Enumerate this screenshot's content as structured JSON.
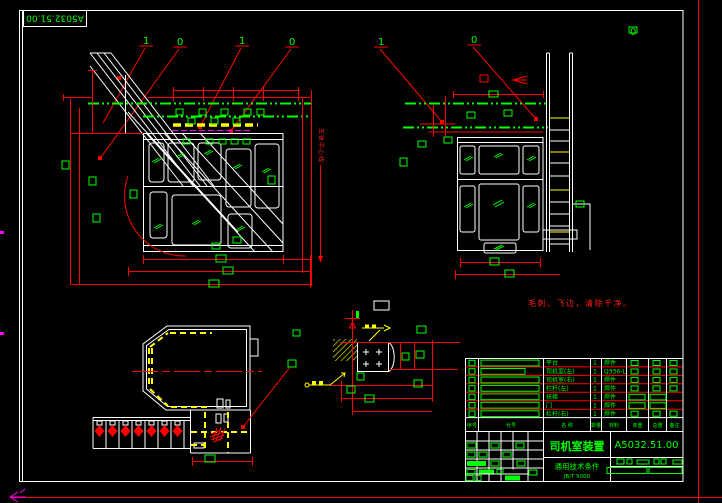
{
  "frame": {
    "corner_drawing_no": "A5032.51.00"
  },
  "notes": {
    "surface_note": "毛刺、飞边，清除干净。",
    "centerline_label": "车体中心线"
  },
  "balloons": [
    {
      "label": "1"
    },
    {
      "label": "0"
    },
    {
      "label": "1"
    },
    {
      "label": "0"
    },
    {
      "label": "1"
    },
    {
      "label": "0"
    },
    {
      "label": "0"
    }
  ],
  "colors": {
    "line_white": "#ffffff",
    "dimension_red": "#ff0000",
    "annotation_green": "#00ff00",
    "highlight_yellow": "#ffff00",
    "aux_magenta": "#ff00ff",
    "background": "#000000"
  },
  "title_block": {
    "title": "司机室装置",
    "drawing_no": "A5032.51.00",
    "spec_title": "通用技术条件",
    "spec_code": "JB/T 5000",
    "bom": {
      "headers": [
        "序号",
        "代号",
        "名 称",
        "数量",
        "材料",
        "单重",
        "总重",
        "备注"
      ],
      "rows": [
        {
          "name": "平台",
          "qty": "1",
          "remark": "焊件"
        },
        {
          "name": "司机室(左)",
          "qty": "1",
          "remark": "Q336-L"
        },
        {
          "name": "司机室(右)",
          "qty": "1",
          "remark": "焊件"
        },
        {
          "name": "栏杆(左)",
          "qty": "1",
          "remark": "焊件"
        },
        {
          "name": "扶梯",
          "qty": "1",
          "remark": "焊件"
        },
        {
          "name": "门",
          "qty": "1",
          "remark": "焊件"
        },
        {
          "name": "栏杆(右)",
          "qty": "1",
          "remark": "焊件"
        }
      ]
    }
  }
}
